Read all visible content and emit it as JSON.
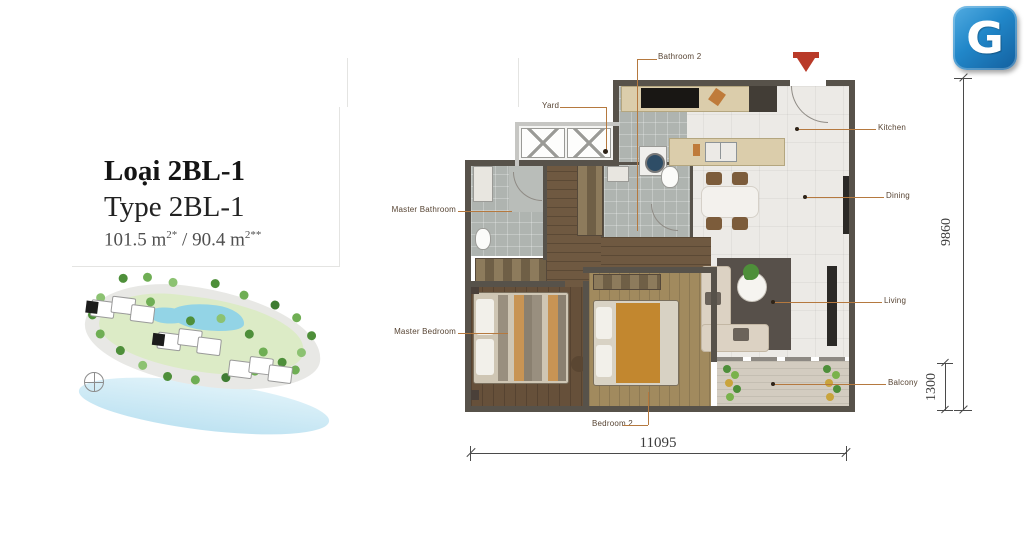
{
  "logo": {
    "letter": "G"
  },
  "title_block": {
    "title_vi": "Loại 2BL-1",
    "title_en": "Type 2BL-1",
    "area_value_1": "101.5 m",
    "area_sup_1": "2*",
    "area_separator": " / ",
    "area_value_2": "90.4 m",
    "area_sup_2": "2**"
  },
  "floor_plan": {
    "labels": {
      "bathroom2": "Bathroom 2",
      "yard": "Yard",
      "master_bathroom": "Master Bathroom",
      "master_bedroom": "Master Bedroom",
      "bedroom2": "Bedroom 2",
      "kitchen": "Kitchen",
      "dining": "Dining",
      "living": "Living",
      "balcony": "Balcony"
    },
    "dimensions": {
      "total_width": "11095",
      "total_depth": "9860",
      "balcony_depth": "1300"
    }
  },
  "colors": {
    "leader_line": "#b5793f",
    "wall": "#57524a",
    "logo_blue": "#2187c9",
    "entry_marker_red": "#b93a28",
    "lake_blue": "#93d4e6",
    "land_green": "#dcebc6"
  }
}
